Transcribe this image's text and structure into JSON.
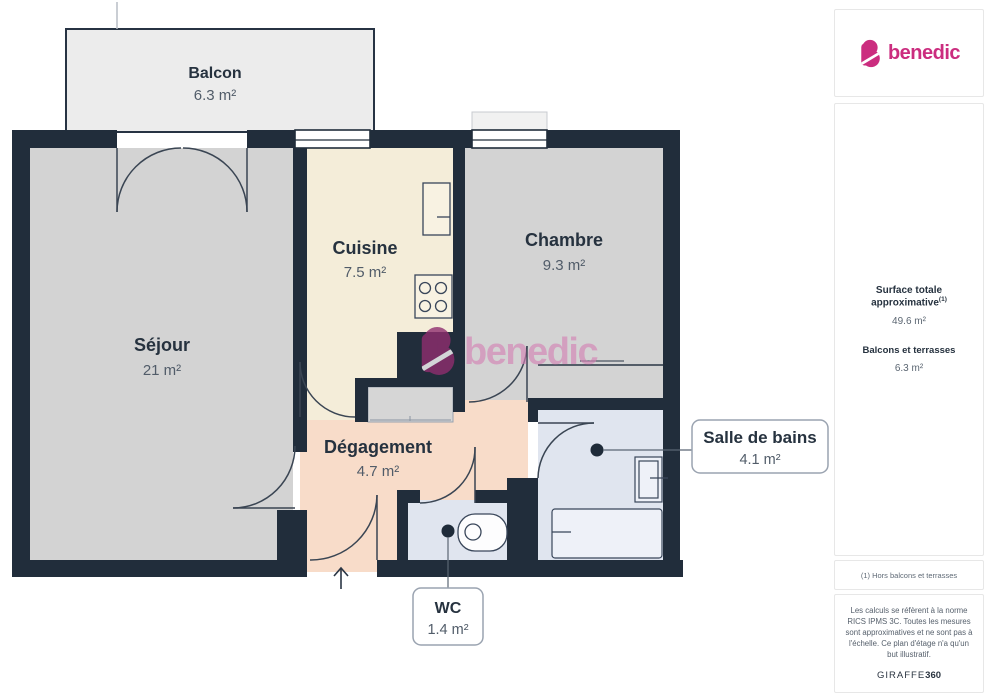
{
  "logo": {
    "name": "benedic"
  },
  "watermark": {
    "name": "benedic"
  },
  "rooms": {
    "balcon": {
      "label": "Balcon",
      "area": "6.3 m²"
    },
    "sejour": {
      "label": "Séjour",
      "area": "21 m²"
    },
    "cuisine": {
      "label": "Cuisine",
      "area": "7.5 m²"
    },
    "chambre": {
      "label": "Chambre",
      "area": "9.3 m²"
    },
    "degagement": {
      "label": "Dégagement",
      "area": "4.7 m²"
    },
    "salle_de_bains": {
      "label": "Salle de bains",
      "area": "4.1 m²"
    },
    "wc": {
      "label": "WC",
      "area": "1.4 m²"
    }
  },
  "sidebar": {
    "surface_title": "Surface totale approximative",
    "surface_sup": "(1)",
    "surface_value": "49.6 m²",
    "balcony_title": "Balcons et terrasses",
    "balcony_value": "6.3 m²",
    "footnote": "(1) Hors balcons et terrasses",
    "disclaimer": "Les calculs se réfèrent à la norme RICS IPMS 3C. Toutes les mesures sont approximatives et ne sont pas à l'échelle. Ce plan d'étage n'a qu'un but illustratif.",
    "brand": "GIRAFFE",
    "brand_suffix": "360"
  },
  "colors": {
    "wall": "#212d3b",
    "floor_gray": "#d3d3d3",
    "balcony": "#ececec",
    "cuisine": "#f4edd9",
    "degagement": "#f8dcc9",
    "wet_room": "#e0e5ef",
    "closet": "#d6d6d6",
    "line": "#3a4553",
    "brand_pink": "#cb2d7f",
    "watermark_dark": "#8f2e6f",
    "watermark_pink": "#d583b6"
  }
}
